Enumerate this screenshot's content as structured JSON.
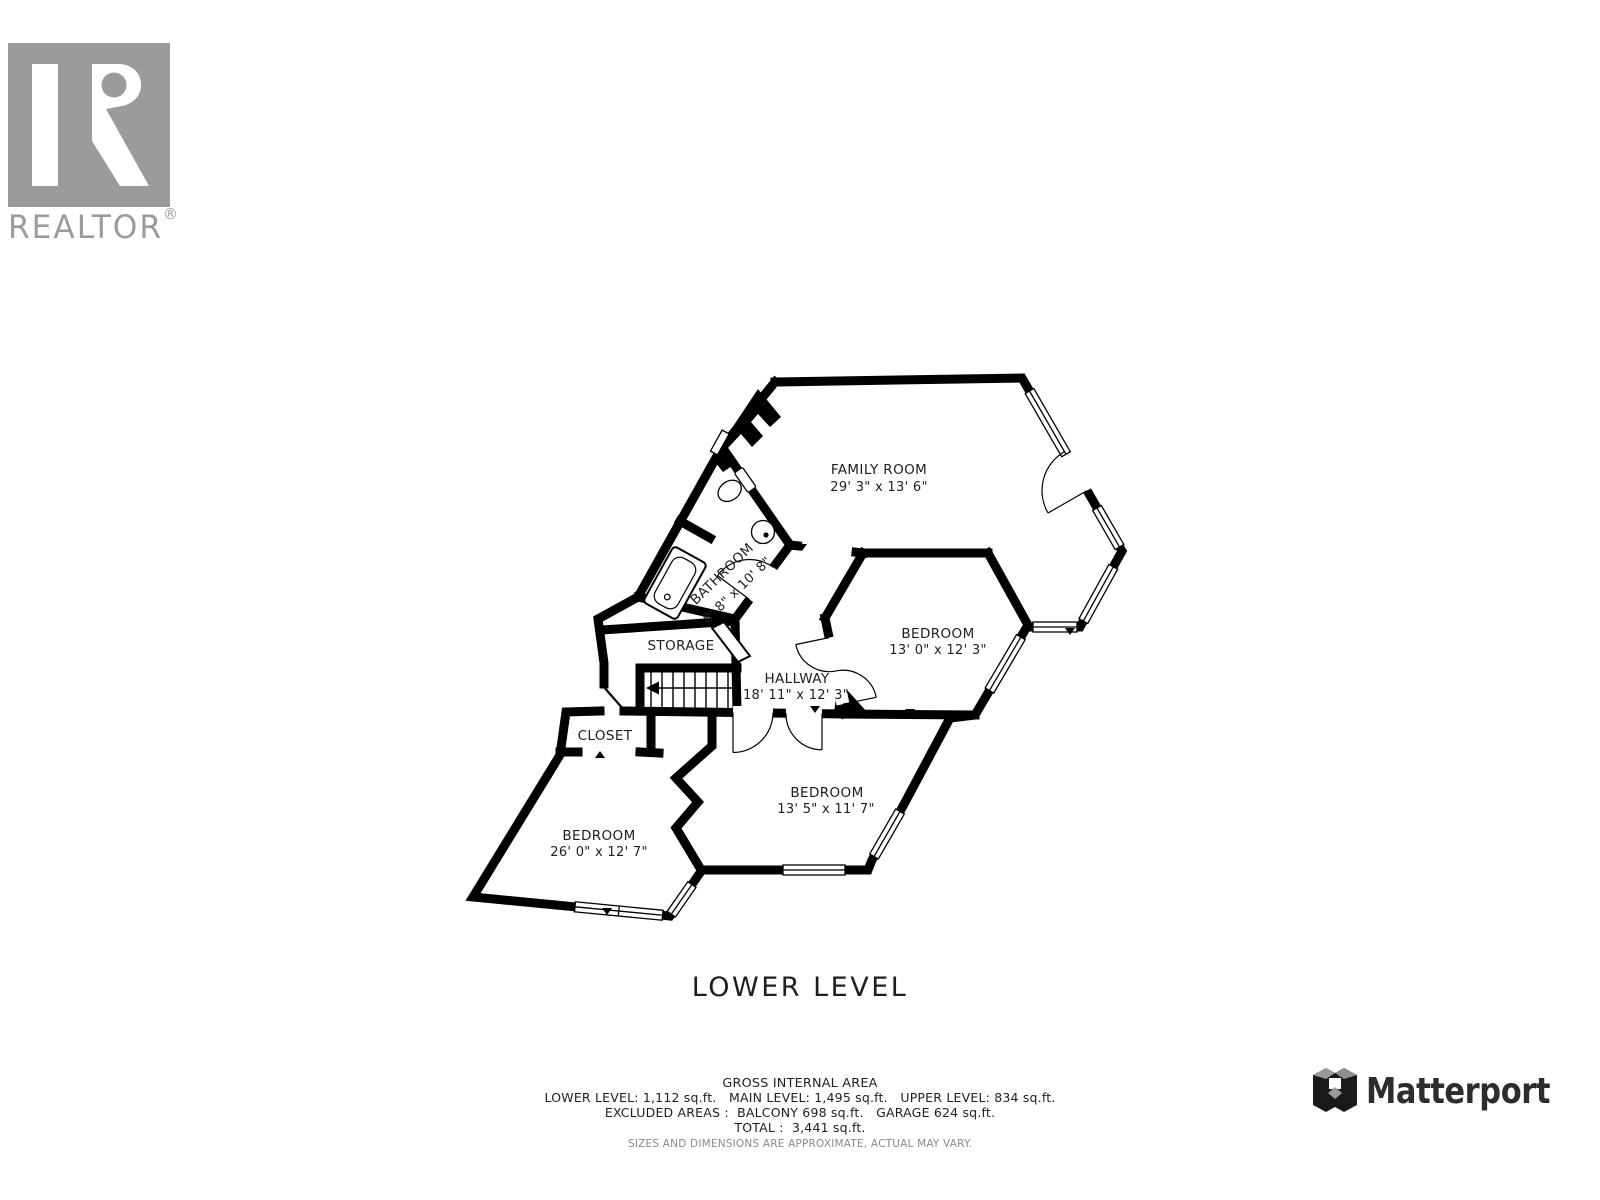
{
  "branding": {
    "realtor": {
      "logo_text": "REALTOR",
      "registered_mark": "®"
    },
    "matterport": {
      "logo_text": "Matterport"
    }
  },
  "floor": {
    "title": "LOWER LEVEL"
  },
  "rooms": {
    "family_room": {
      "name": "FAMILY ROOM",
      "dims": "29' 3\" x 13' 6\""
    },
    "bathroom": {
      "name": "BATHROOM",
      "dims": "8' 8\" x 10' 8\""
    },
    "storage": {
      "name": "STORAGE"
    },
    "hallway": {
      "name": "HALLWAY",
      "dims": "18' 11\" x 12' 3\""
    },
    "closet": {
      "name": "CLOSET"
    },
    "bedroom_ne": {
      "name": "BEDROOM",
      "dims": "13' 0\" x 12' 3\""
    },
    "bedroom_mid": {
      "name": "BEDROOM",
      "dims": "13' 5\" x 11' 7\""
    },
    "bedroom_sw": {
      "name": "BEDROOM",
      "dims": "26' 0\" x 12' 7\""
    }
  },
  "area_summary": {
    "heading": "GROSS INTERNAL AREA",
    "levels_line": "LOWER LEVEL: 1,112 sq.ft.   MAIN LEVEL: 1,495 sq.ft.   UPPER LEVEL: 834 sq.ft.",
    "excluded_line": "EXCLUDED AREAS :  BALCONY 698 sq.ft.   GARAGE 624 sq.ft.",
    "total_line": "TOTAL :  3,441 sq.ft.",
    "disclaimer": "SIZES AND DIMENSIONS ARE APPROXIMATE, ACTUAL MAY VARY."
  },
  "colors": {
    "wall": "#000000",
    "text": "#1e1e1e",
    "realtor_gray": "#9b9b9b",
    "matterport_dark": "#2d2d2d",
    "matterport_gray": "#9a9a9a",
    "disclaimer_gray": "#8a8a8a",
    "background": "#ffffff"
  }
}
